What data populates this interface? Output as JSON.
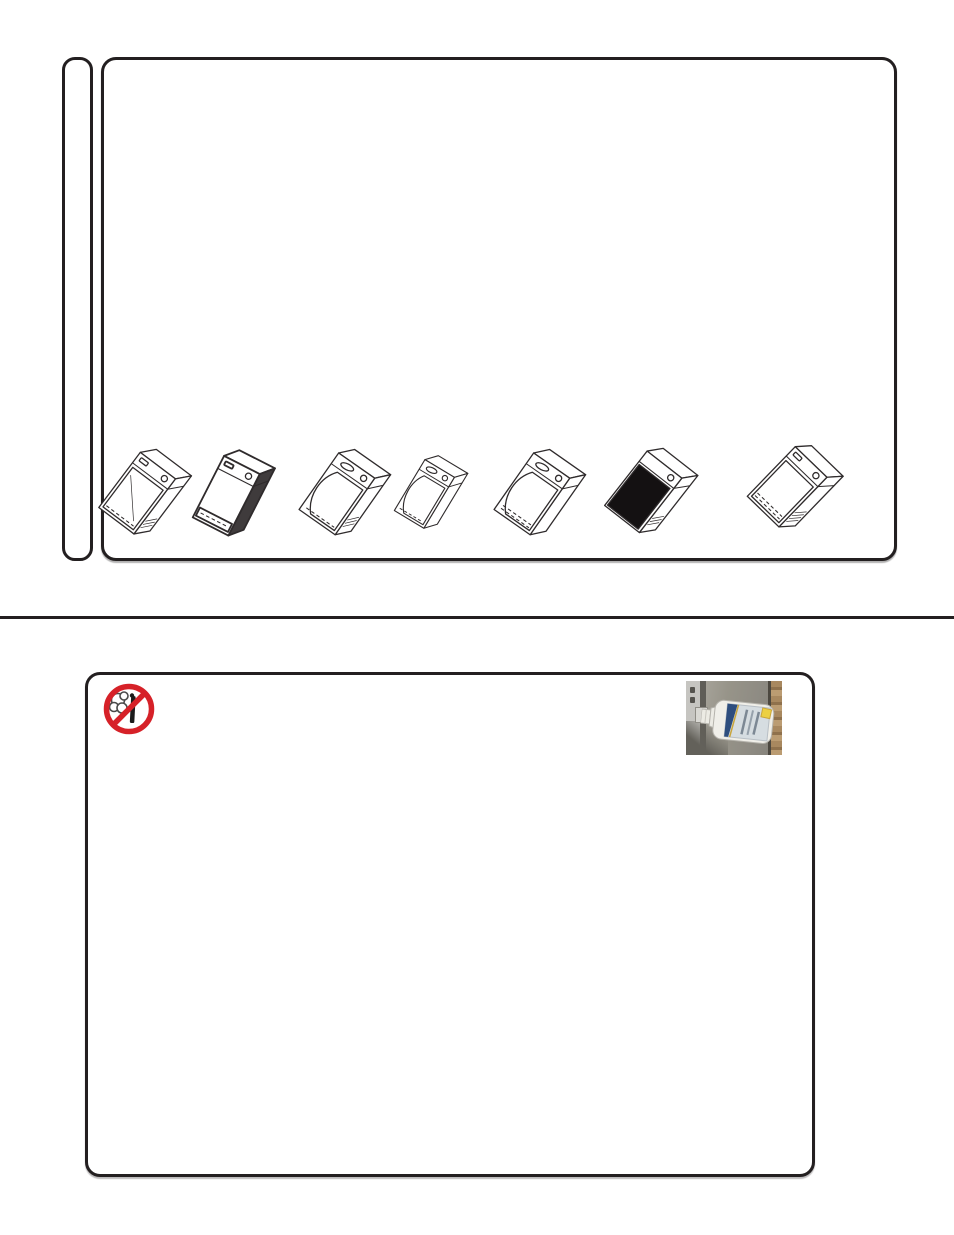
{
  "page": {
    "kind": "appliance-manual-page",
    "background_color": "#ffffff",
    "line_color": "#231f20",
    "has_text": false
  },
  "top_section": {
    "name": "product-family-panel",
    "side_tab": {
      "icon": "blank-side-tab"
    },
    "drawing_count": 7,
    "drawings": [
      {
        "icon": "undercounter-appliance-drawing-1-flat-door"
      },
      {
        "icon": "undercounter-appliance-drawing-2-solid-box-shaded-side"
      },
      {
        "icon": "undercounter-appliance-drawing-3-rounded-door"
      },
      {
        "icon": "undercounter-appliance-drawing-4-slim-rounded-door"
      },
      {
        "icon": "undercounter-appliance-drawing-5-rounded-door"
      },
      {
        "icon": "undercounter-appliance-drawing-6-black-glass-door"
      },
      {
        "icon": "undercounter-appliance-drawing-7-vented-flat-door"
      }
    ]
  },
  "divider": {
    "color": "#231f20"
  },
  "bottom_section": {
    "name": "cleaning-care-panel",
    "prohibition_icon": {
      "icon": "no-steam-cleaning-icon",
      "ring_color": "#d62128",
      "glyph_color": "#1b1b1b",
      "smoke_color": "#4a4a4a"
    },
    "photo": {
      "icon": "stainless-steel-cleaner-bottle-photo",
      "colors": {
        "steel": "#93908a",
        "wood_edge": "#a5855e",
        "bottle": "#f0efe9",
        "label": "#d6dde1",
        "label_band": "#2e4e7e",
        "price_sticker": "#ecd043"
      }
    }
  }
}
